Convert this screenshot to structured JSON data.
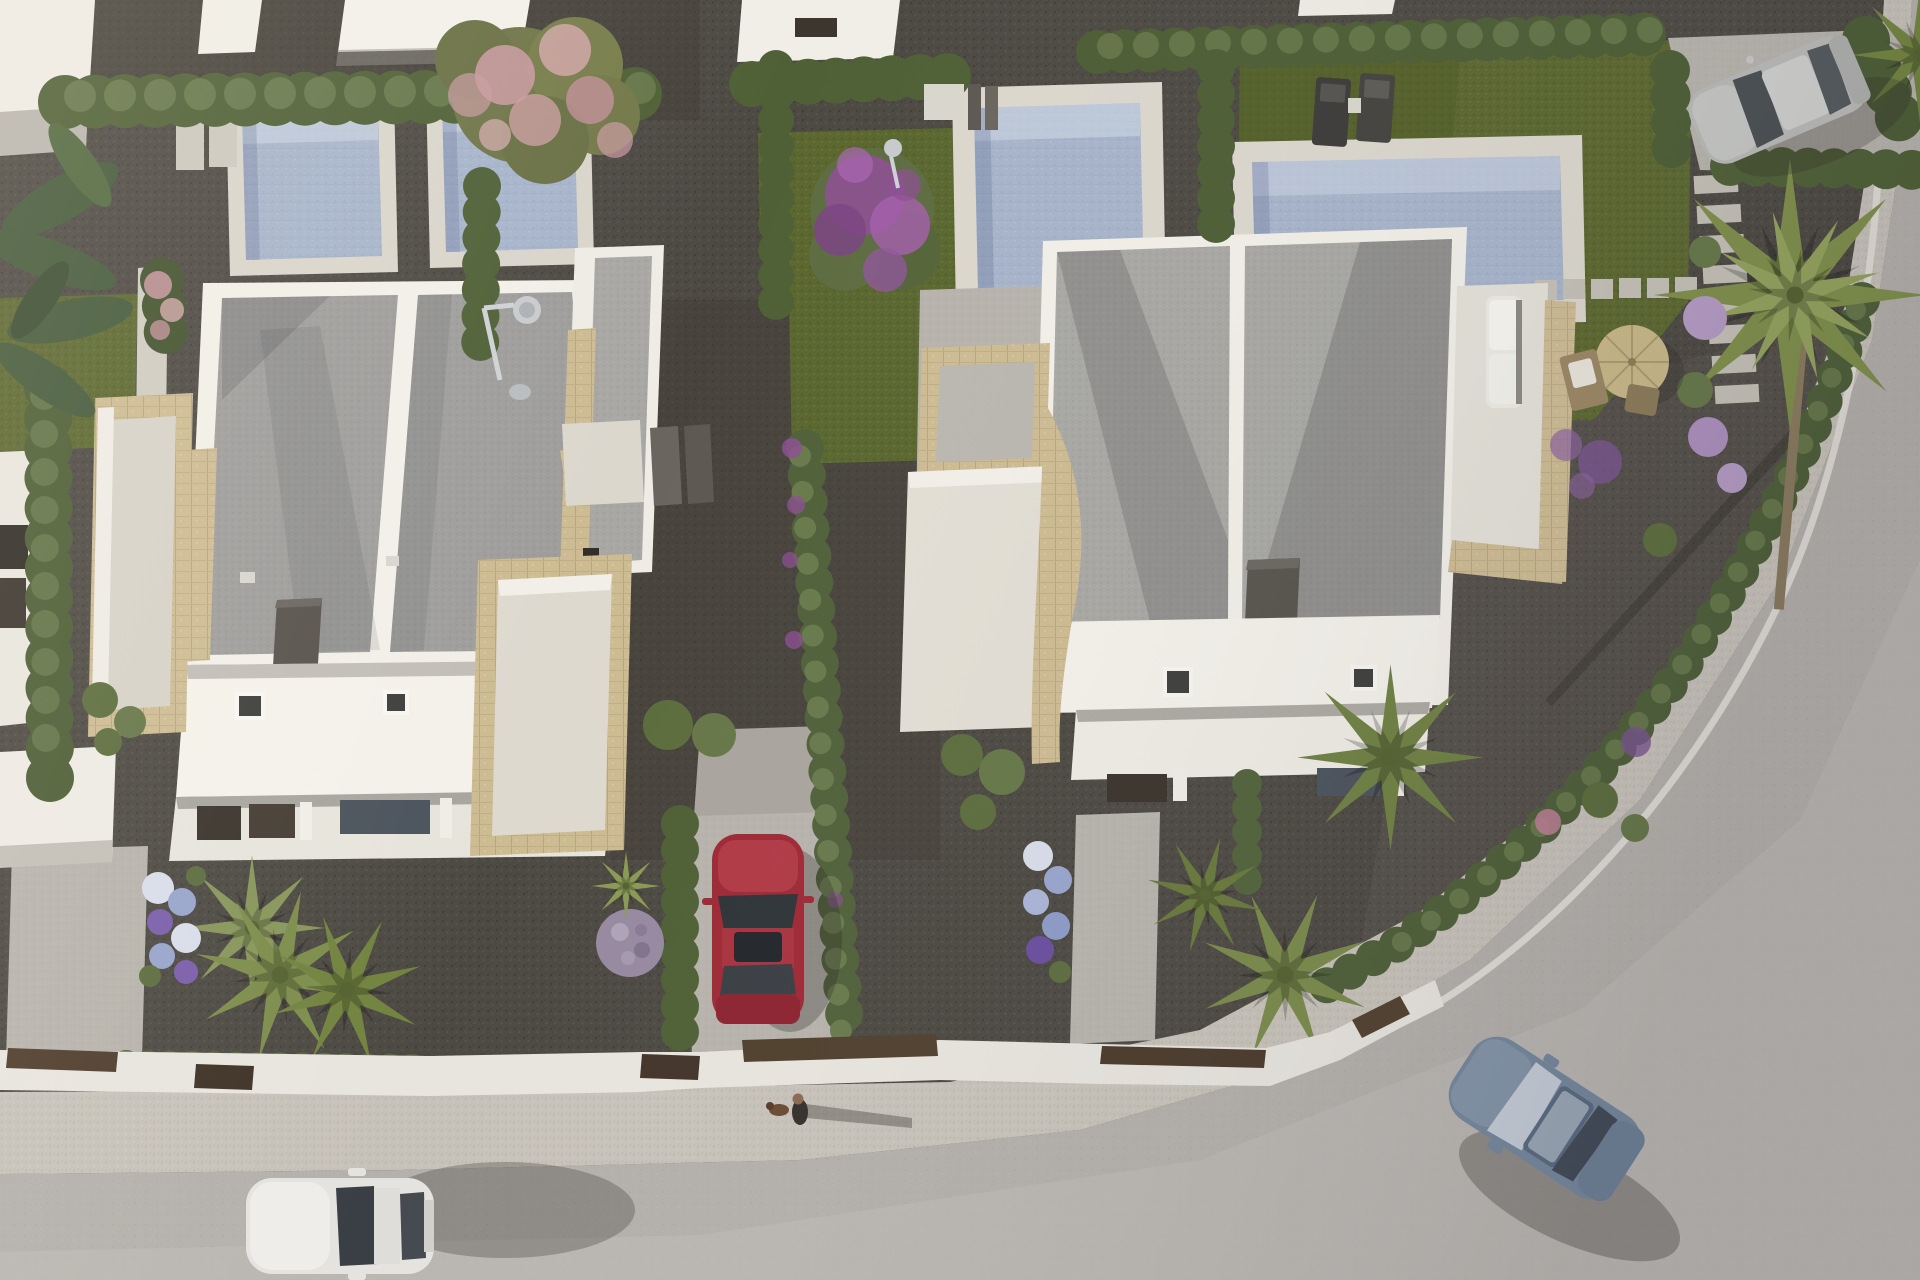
{
  "meta": {
    "title": "Aerial 3D render of modern villa development",
    "image_type": "photorealistic-architectural-render",
    "view": "top-down aerial, late-afternoon sun from the west (long shadows to the east)",
    "width_px": 1920,
    "height_px": 1280,
    "visible_text": "none"
  },
  "scene": {
    "description": "Top-down aerial render of a row of modern white flat-roofed villas with gravel roofs, travertine-clad terraces, private pools, olive-green lawns, cypress hedges, palm trees and a curved asphalt street with sidewalk at the bottom-right. Four cars, one pedestrian walking a dog.",
    "palette": {
      "gravel_dark": "#4d4943",
      "road_asphalt": "#b4b0ab",
      "sidewalk": "#c7c2b9",
      "white_wall": "#f2efe8",
      "roof_gravel": "#9e9d9b",
      "travertine_stone": "#cdbb92",
      "pool_water": "#a7b4ca",
      "pool_deck": "#d9d5cb",
      "lawn_olive": "#5b672f",
      "hedge_green": "#4f6036",
      "palm_green": "#7d8d4b",
      "pink_blossom": "#cb9aa2",
      "purple_blossom": "#8e4f96",
      "red_car": "#9e2a36",
      "white_car": "#e5e3df",
      "blue_car": "#76889d",
      "silver_car": "#b9bab7",
      "corten_brown": "#4f3d2c"
    }
  },
  "objects": {
    "buildings": [
      {
        "name": "left-villa",
        "bbox": [
          150,
          245,
          510,
          620
        ],
        "features": [
          "two gray gravel roof panels with white ridge",
          "dark chimney box",
          "white lower band with 2 skylights",
          "stone-clad side terraces",
          "ground-floor porch with dark windows"
        ]
      },
      {
        "name": "right-villa",
        "bbox": [
          900,
          225,
          680,
          560
        ],
        "features": [
          "two gray gravel roof panels with white ridge",
          "dark chimney box",
          "white band with 2 skylights",
          "stone terraces both sides",
          "white sofa on right roof terrace"
        ]
      },
      {
        "name": "neighbor-roof-slabs-top",
        "count": 5,
        "bbox": [
          0,
          0,
          1400,
          120
        ]
      },
      {
        "name": "neighbor-facade-left-edge",
        "bbox": [
          0,
          368,
          42,
          358
        ],
        "features": [
          "dark window slits"
        ]
      },
      {
        "name": "garage-slab-left",
        "bbox": [
          0,
          746,
          116,
          118
        ]
      }
    ],
    "pools": [
      {
        "name": "pool-A",
        "deck_bbox": [
          226,
          94,
          172,
          182
        ],
        "water": "pale blue tiled"
      },
      {
        "name": "pool-B",
        "deck_bbox": [
          426,
          82,
          168,
          186
        ],
        "water": "pale blue tiled"
      },
      {
        "name": "pool-C",
        "deck_bbox": [
          952,
          82,
          210,
          229
        ],
        "water": "pale blue tiled"
      },
      {
        "name": "pool-D",
        "deck_bbox": [
          1232,
          135,
          350,
          192
        ],
        "water": "pale blue tiled"
      }
    ],
    "vehicles": [
      {
        "name": "white-hatchback",
        "location": "street bottom-left",
        "bbox": [
          246,
          1170,
          190,
          102
        ],
        "heading": "west"
      },
      {
        "name": "red-sedan",
        "location": "driveway between villas",
        "bbox": [
          712,
          834,
          92,
          190
        ],
        "heading": "north"
      },
      {
        "name": "blue-coupe",
        "location": "curved street bottom-right",
        "bbox": [
          1445,
          1042,
          200,
          150
        ],
        "heading": "south-west"
      },
      {
        "name": "silver-suv",
        "location": "top-right driveway",
        "bbox": [
          1690,
          52,
          175,
          100
        ],
        "heading": "south-west"
      }
    ],
    "people": [
      {
        "name": "pedestrian-with-dog",
        "bbox": [
          770,
          1090,
          50,
          45
        ],
        "shadow": "long, pointing east"
      }
    ],
    "vegetation": {
      "flowering_trees": [
        {
          "name": "pink-blossom-tree",
          "center": [
            537,
            92
          ]
        },
        {
          "name": "purple-bougainvillea-tree",
          "center": [
            872,
            212
          ]
        }
      ],
      "palms": [
        {
          "center": [
            252,
            928
          ]
        },
        {
          "center": [
            345,
            988
          ]
        },
        {
          "center": [
            300,
            862
          ]
        },
        {
          "center": [
            1390,
            755
          ]
        },
        {
          "center": [
            1285,
            975
          ]
        },
        {
          "center": [
            1205,
            893
          ]
        },
        {
          "center": [
            1790,
            295
          ],
          "note": "tall fan palm over road, visible trunk"
        }
      ],
      "banana_plant": {
        "bbox": [
          0,
          135,
          150,
          300
        ]
      },
      "lawns": [
        {
          "name": "left-lawn",
          "bbox": [
            0,
            295,
            140,
            150
          ]
        },
        {
          "name": "middle-lawn",
          "bbox": [
            758,
            128,
            240,
            335
          ]
        },
        {
          "name": "right-lawn",
          "bbox": [
            1238,
            40,
            455,
            385
          ]
        }
      ],
      "hedges": [
        "back hedge row full width",
        "vertical cypress dividers between gardens",
        "front street hedges on white walls",
        "hedge line following road curve",
        "hedges around top-right driveway"
      ],
      "flower_beds": [
        {
          "name": "hydrangea-bed-left",
          "bbox": [
            138,
            862,
            90,
            135
          ],
          "colors": [
            "white",
            "blue",
            "purple"
          ]
        },
        {
          "name": "hydrangea-bed-right",
          "bbox": [
            1018,
            835,
            60,
            155
          ],
          "colors": [
            "white",
            "blue",
            "purple"
          ]
        },
        {
          "name": "lilac-pompoms-right-garden",
          "area": [
            1520,
            280,
            240,
            580
          ]
        },
        {
          "name": "lavender-ball",
          "center": [
            630,
            943
          ]
        },
        {
          "name": "yucca",
          "center": [
            625,
            885
          ]
        }
      ]
    },
    "furniture": [
      {
        "name": "sun-loungers",
        "count": 2,
        "bbox": [
          1314,
          72,
          84,
          78
        ],
        "color": "dark gray"
      },
      {
        "name": "straw-parasol",
        "center": [
          1632,
          362
        ],
        "radius": 37
      },
      {
        "name": "deck-chairs",
        "count": 2,
        "near": [
          1585,
          380
        ]
      },
      {
        "name": "white-sofa-roof-terrace",
        "bbox": [
          1486,
          296,
          36,
          112
        ]
      },
      {
        "name": "outdoor-shower-left",
        "at": [
          500,
          330
        ]
      },
      {
        "name": "outdoor-shower-right",
        "at": [
          895,
          160
        ]
      },
      {
        "name": "shower-mats-and-planks",
        "at": [
          600,
          460
        ]
      }
    ],
    "hardscape": [
      {
        "name": "road",
        "area": "bottom-right, curves up the right edge"
      },
      {
        "name": "sidewalk",
        "area": "speckled band between street wall and road"
      },
      {
        "name": "front-walls",
        "area": "white walls with corten-brown gates along street"
      },
      {
        "name": "stepping-stones-vertical",
        "count": 8,
        "from": [
          1715,
          175
        ],
        "to": [
          1715,
          415
        ]
      },
      {
        "name": "stepping-stones-horizontal",
        "count": 6,
        "from": [
          1535,
          285
        ],
        "to": [
          1700,
          285
        ]
      },
      {
        "name": "stepping-slabs-pool-A",
        "count": 2,
        "at": [
          178,
          115
        ]
      },
      {
        "name": "driveways",
        "list": [
          [
            6,
            848,
            142,
            214
          ],
          [
            688,
            806,
            144,
            260
          ],
          [
            1072,
            812,
            88,
            232
          ],
          [
            1668,
            30,
            252,
            148
          ]
        ]
      }
    ]
  }
}
